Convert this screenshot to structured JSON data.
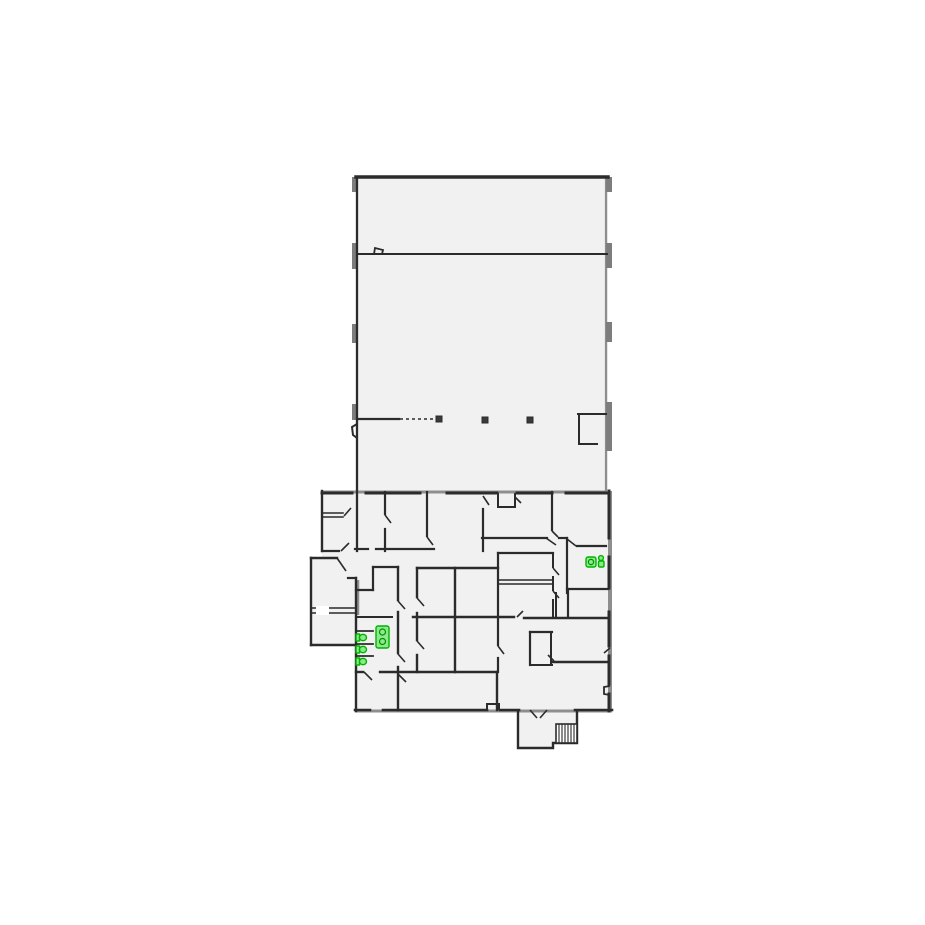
{
  "canvas": {
    "width": 925,
    "height": 925,
    "background": "#ffffff"
  },
  "colors": {
    "floor": "#f1f1f1",
    "wall_dark": "#2b2b2b",
    "wall_gray": "#8e8e8e",
    "pilaster_gray": "#7d7d7d",
    "post": "#3a3a3a",
    "white": "#ffffff",
    "fixture_stroke": "#00b400",
    "fixture_fill": "#8ce98c",
    "fixture_detail": "#008f00"
  },
  "floors": [
    {
      "name": "main-hall-floor",
      "points": "356,176 608,176 608,493 356,493"
    },
    {
      "name": "lower-wing-floor",
      "points": "322,491 612,491 612,711 578,711 578,743 553,743 553,748 518,748 518,711 356,711 356,645 311,645 311,557 322,557"
    }
  ],
  "walls_gray": [
    [
      606,
      177,
      606,
      493,
      2.2
    ],
    [
      322,
      492,
      607,
      492,
      3
    ],
    [
      610,
      491,
      610,
      711,
      4
    ],
    [
      355,
      711,
      612,
      711,
      3
    ],
    [
      358,
      580,
      358,
      615,
      2.5
    ]
  ],
  "pilasters": [
    [
      352,
      177,
      5,
      15
    ],
    [
      352,
      243,
      5,
      26
    ],
    [
      352,
      324,
      5,
      19
    ],
    [
      352,
      404,
      5,
      16
    ],
    [
      606,
      177,
      6,
      15
    ],
    [
      606,
      243,
      6,
      25
    ],
    [
      606,
      322,
      6,
      20
    ],
    [
      606,
      402,
      6,
      49
    ]
  ],
  "walls_dark": [
    [
      356,
      177,
      608,
      177,
      3.5
    ],
    [
      357,
      177,
      357,
      551,
      2.3
    ],
    [
      357,
      254,
      607,
      254,
      2
    ],
    [
      357,
      419,
      399,
      419,
      2.2
    ],
    [
      578,
      414,
      606,
      414,
      2
    ],
    [
      579,
      414,
      579,
      444,
      2
    ],
    [
      579,
      444,
      597,
      444,
      2
    ],
    [
      322,
      493,
      352,
      493,
      3
    ],
    [
      366,
      493,
      420,
      493,
      3
    ],
    [
      447,
      493,
      497,
      493,
      3
    ],
    [
      517,
      493,
      552,
      493,
      3
    ],
    [
      566,
      493,
      607,
      493,
      3
    ],
    [
      609,
      491,
      609,
      538,
      3
    ],
    [
      609,
      557,
      609,
      588,
      3
    ],
    [
      609,
      612,
      609,
      646,
      3
    ],
    [
      609,
      656,
      609,
      684,
      3
    ],
    [
      609,
      694,
      609,
      711,
      3
    ],
    [
      355,
      710,
      370,
      710,
      2.6
    ],
    [
      383,
      710,
      487,
      710,
      2.6
    ],
    [
      500,
      710,
      519,
      710,
      2.6
    ],
    [
      575,
      710,
      612,
      710,
      2.6
    ],
    [
      322,
      491,
      322,
      551,
      2.4
    ],
    [
      322,
      551,
      339,
      551,
      2.2
    ],
    [
      311,
      558,
      337,
      558,
      2.4
    ],
    [
      311,
      558,
      311,
      645,
      2.4
    ],
    [
      311,
      645,
      356,
      645,
      2.4
    ],
    [
      311,
      608,
      355,
      608,
      1.6
    ],
    [
      311,
      613,
      355,
      613,
      1.6
    ],
    [
      322,
      513,
      343,
      513,
      1.6
    ],
    [
      322,
      517,
      343,
      517,
      1.6
    ],
    [
      348,
      578,
      356,
      578,
      2.2
    ],
    [
      356,
      578,
      356,
      711,
      2.4
    ],
    [
      385,
      492,
      385,
      514,
      2.2
    ],
    [
      385,
      529,
      385,
      551,
      2.2
    ],
    [
      427,
      492,
      427,
      536,
      2.2
    ],
    [
      483,
      509,
      483,
      551,
      2.2
    ],
    [
      552,
      492,
      552,
      530,
      2.2
    ],
    [
      498,
      494,
      498,
      507,
      2
    ],
    [
      515,
      494,
      515,
      507,
      2
    ],
    [
      498,
      507,
      515,
      507,
      2
    ],
    [
      355,
      549,
      368,
      549,
      2.2
    ],
    [
      376,
      549,
      434,
      549,
      2.2
    ],
    [
      482,
      538,
      547,
      538,
      2.2
    ],
    [
      559,
      538,
      567,
      538,
      2.2
    ],
    [
      567,
      538,
      567,
      593,
      2.2
    ],
    [
      577,
      546,
      606,
      546,
      2.2
    ],
    [
      567,
      589,
      608,
      589,
      2.2
    ],
    [
      568,
      589,
      568,
      617,
      2.2
    ],
    [
      556,
      593,
      556,
      617,
      2
    ],
    [
      498,
      553,
      553,
      553,
      2.2
    ],
    [
      498,
      580,
      553,
      580,
      1.6
    ],
    [
      498,
      584,
      553,
      584,
      1.6
    ],
    [
      553,
      553,
      553,
      567,
      2
    ],
    [
      553,
      577,
      553,
      590,
      2
    ],
    [
      553,
      600,
      553,
      616,
      2
    ],
    [
      413,
      617,
      514,
      617,
      2.4
    ],
    [
      524,
      618,
      608,
      618,
      2.4
    ],
    [
      417,
      568,
      498,
      568,
      2.4
    ],
    [
      417,
      568,
      417,
      597,
      2.4
    ],
    [
      417,
      613,
      417,
      640,
      2.4
    ],
    [
      417,
      655,
      417,
      672,
      2.4
    ],
    [
      455,
      568,
      455,
      672,
      2.4
    ],
    [
      498,
      553,
      498,
      645,
      2.2
    ],
    [
      498,
      658,
      498,
      672,
      2.2
    ],
    [
      530,
      632,
      552,
      632,
      2.2
    ],
    [
      530,
      632,
      530,
      665,
      2.2
    ],
    [
      551,
      632,
      551,
      665,
      2
    ],
    [
      530,
      665,
      552,
      665,
      2
    ],
    [
      553,
      662,
      608,
      662,
      2.4
    ],
    [
      373,
      567,
      398,
      567,
      2.2
    ],
    [
      373,
      567,
      373,
      590,
      2.2
    ],
    [
      356,
      590,
      373,
      590,
      2.2
    ],
    [
      357,
      617,
      392,
      617,
      2
    ],
    [
      356,
      631,
      373,
      631,
      1.8
    ],
    [
      356,
      644,
      373,
      644,
      1.8
    ],
    [
      356,
      656,
      373,
      656,
      1.8
    ],
    [
      398,
      567,
      398,
      600,
      2.4
    ],
    [
      398,
      612,
      398,
      653,
      2.4
    ],
    [
      398,
      667,
      398,
      710,
      2.4
    ],
    [
      356,
      672,
      363,
      672,
      2.4
    ],
    [
      380,
      672,
      497,
      672,
      2.4
    ],
    [
      497,
      672,
      497,
      710,
      2.4
    ]
  ],
  "wall_polylines": [
    {
      "name": "hall-left-door-notch",
      "w": 2,
      "points": "357,424 352,427 353,435 357,438"
    },
    {
      "name": "hall-divider-door-bump",
      "w": 1.8,
      "points": "374,254 375,248 383,250 382,254"
    },
    {
      "name": "bottom-wall-notch",
      "w": 2,
      "points": "487,710 487,704 499,704 499,710"
    },
    {
      "name": "right-wall-door-notch",
      "w": 1.8,
      "points": "610,686 604,687 604,694 610,695"
    },
    {
      "name": "vestibule-outline",
      "w": 2.4,
      "points": "518,710 518,748 553,748 553,743 577,743 577,710"
    }
  ],
  "windows_white": [
    [
      316,
      606,
      13,
      9
    ]
  ],
  "dashed_lines": [
    [
      400,
      419,
      436,
      419
    ]
  ],
  "posts": [
    [
      436,
      416
    ],
    [
      482,
      417
    ],
    [
      527,
      417
    ]
  ],
  "post_size": 6,
  "door_swings": [
    [
      344,
      516,
      351,
      508
    ],
    [
      341,
      551,
      349,
      543
    ],
    [
      337,
      558,
      346,
      571
    ],
    [
      385,
      515,
      391,
      523
    ],
    [
      427,
      537,
      433,
      545
    ],
    [
      483,
      496,
      489,
      505
    ],
    [
      515,
      497,
      521,
      503
    ],
    [
      552,
      531,
      558,
      537
    ],
    [
      546,
      538,
      556,
      545
    ],
    [
      567,
      539,
      576,
      546
    ],
    [
      553,
      568,
      559,
      575
    ],
    [
      553,
      591,
      559,
      598
    ],
    [
      498,
      646,
      504,
      654
    ],
    [
      517,
      617,
      523,
      611
    ],
    [
      417,
      598,
      424,
      606
    ],
    [
      417,
      641,
      424,
      649
    ],
    [
      398,
      601,
      405,
      609
    ],
    [
      398,
      654,
      405,
      662
    ],
    [
      364,
      672,
      372,
      680
    ],
    [
      398,
      674,
      406,
      682
    ],
    [
      530,
      710,
      537,
      718
    ],
    [
      547,
      710,
      540,
      718
    ],
    [
      548,
      655,
      554,
      661
    ],
    [
      610,
      648,
      604,
      653
    ]
  ],
  "stairs": {
    "name": "staircase",
    "x": 556,
    "y": 724,
    "w": 21,
    "h": 19,
    "treads": 6
  },
  "fixtures": [
    {
      "type": "toilet-top-icon",
      "x": 586,
      "y": 557
    },
    {
      "type": "person-sink-icon",
      "x": 597,
      "y": 555
    },
    {
      "type": "double-sink-icon",
      "x": 376,
      "y": 626
    },
    {
      "type": "toilet-side-icon",
      "x": 356,
      "y": 633
    },
    {
      "type": "toilet-side-icon",
      "x": 356,
      "y": 645
    },
    {
      "type": "toilet-side-icon",
      "x": 356,
      "y": 657
    }
  ]
}
